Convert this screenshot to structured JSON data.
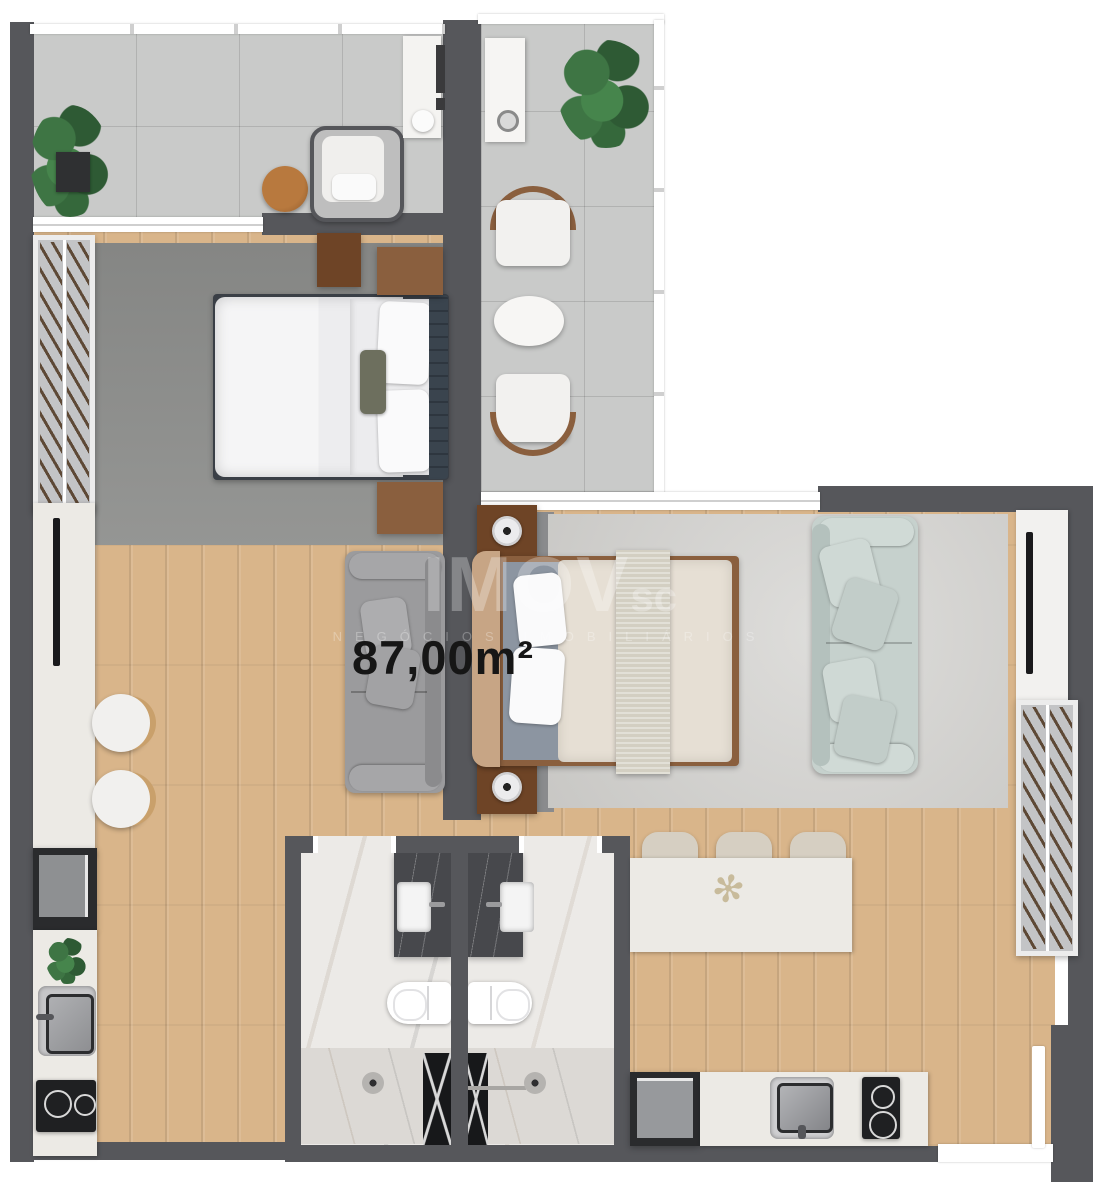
{
  "floorplan": {
    "area_label": "87,00m²",
    "watermark": {
      "brand": "IMOV",
      "brand_suffix": "sc",
      "tagline": "NEGÓCIOS IMOBILIÁRIOS"
    },
    "icons": {
      "dried_plant": "✻"
    },
    "palette": {
      "wall": "#56575B",
      "wood": "#D9B58A",
      "tile": "#C9CAC9",
      "rug_dark": "#8F908E",
      "rug_mid": "#8A8B8D",
      "rug_light": "#D3D2CF",
      "marble": "#ECEAE7",
      "marble_shower": "#DCD9D5",
      "marble_dark": "#47484C",
      "counter": "#ECEAE5",
      "appliance": "#2A2B2D",
      "steel": "#A8A9AC",
      "wood_furn": "#8A5F3E",
      "wood_furn_dark": "#6E4426",
      "plant_green_a": "#3E7544",
      "plant_green_b": "#2E5A34",
      "sofa_gray": "#9B9B9D",
      "sofa_mint": "#C6D1CD",
      "headboard_navy": "#3A444E",
      "bed2_tan": "#C7A585",
      "bed2_beige": "#E6DFD4",
      "bed2_throw": "#D3CFC2",
      "bed2_sheet": "#8C95A1",
      "label_ink": "#161616"
    }
  }
}
